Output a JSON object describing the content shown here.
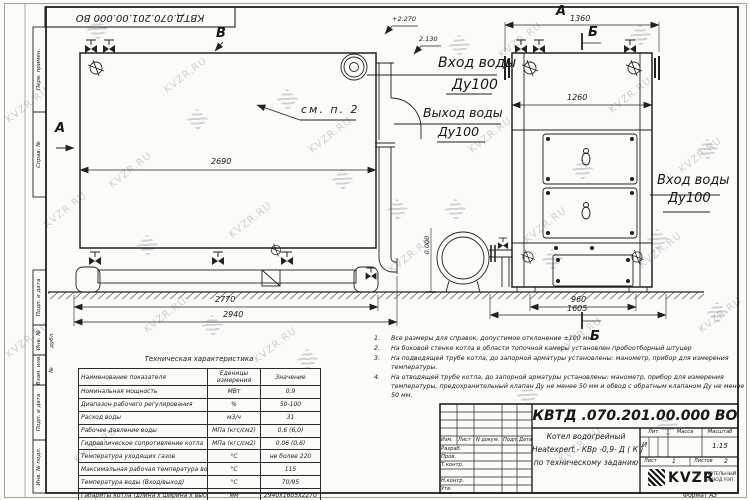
{
  "sheet": {
    "watermark": "KVZR.RU",
    "stamp": "КВТД.070.201.00.000  ВО",
    "format_note": "Формат    А3"
  },
  "margin_labels": [
    {
      "label": "Перв. примен."
    },
    {
      "label": "Справ. №"
    },
    {
      "label": "Подп. и дата"
    },
    {
      "label": "Инв. № дубл."
    },
    {
      "label": "Взам. инв. №"
    },
    {
      "label": "Подп. и дата"
    },
    {
      "label": "Инв. № подл."
    }
  ],
  "side_view": {
    "view_b": "В",
    "view_a": "А",
    "see_note": "см. п. 2",
    "elev_top": "+2.270",
    "elev_inlet": "2.130",
    "elev_ground": "0.000",
    "inlet_line1": "Вход воды",
    "inlet_line2": "Ду100",
    "outlet_line1": "Выход воды",
    "outlet_line2": "Ду100",
    "dim_body": "2690",
    "dim_base": "2770",
    "dim_overall": "2940"
  },
  "front_view": {
    "view_label": "А",
    "section_label_top": "Б",
    "section_label_bottom": "Б",
    "dim_top": "1360",
    "dim_inner": "1260",
    "dim_base": "960",
    "dim_overall": "1605",
    "inlet_line1": "Вход воды",
    "inlet_line2": "Ду100"
  },
  "tech_table": {
    "title": "Техническая характеристика",
    "col_name": "Наименование показателя",
    "col_units_1": "Еденицы",
    "col_units_2": "измерения",
    "col_value": "Значение",
    "rows": [
      {
        "name": "Номинальная мощность",
        "units": "МВт",
        "value": "0,9"
      },
      {
        "name": "Диапазон рабочего регулирования",
        "units": "%",
        "value": "50-100"
      },
      {
        "name": "Расход воды",
        "units": "м3/ч",
        "value": "31"
      },
      {
        "name": "Рабочее давление воды",
        "units": "МПа (кгс/см2)",
        "value": "0,6 (6,0)"
      },
      {
        "name": "Гидравлическое сопротивление котла",
        "units": "МПа (кгс/см2)",
        "value": "0,06 (0,6)"
      },
      {
        "name": "Температура уходящих газов",
        "units": "°С",
        "value": "не более 220"
      },
      {
        "name": "Максимальная рабочая температура воды",
        "units": "°С",
        "value": "115"
      },
      {
        "name": "Температура воды (Вход/выход)",
        "units": "°С",
        "value": "70/95"
      },
      {
        "name": "Габариты котла (длина х ширина х высота)",
        "units": "мм",
        "value": "2940х1605х2270"
      }
    ]
  },
  "notes": [
    {
      "num": "1.",
      "line1": "Все размеры для справок, допустимое отклонение  ±100 мм."
    },
    {
      "num": "2.",
      "line1": "На боковой стенке котла в области топочной камеры установлен пробоотборный штуцер"
    },
    {
      "num": "3.",
      "line1": "На  подводящей трубе котла, до запорной арматуры установлены: манометр, прибор для измерения",
      "line2": "температуры."
    },
    {
      "num": "4.",
      "line1": "На отводящей трубе котла, до запорной арматуры установлены: манометр, прибор для измерения",
      "line2": "температуры, предохранительный клапан  Ду не менее 50 мм и обвод с обратным клапаном  Ду не менее",
      "line3": "50 мм."
    }
  ],
  "title_block": {
    "doc_number": "КВТД .070.201.00.000   ВО",
    "name_line1": "Котел водогрейный",
    "name_line2": "Heatexpert - КВр -0,9- Д ( К )",
    "name_line3": "по техническому заданию",
    "col_izm": "Изм.",
    "col_list": "Лист",
    "col_doc": "N докум.",
    "col_sign": "Подп.",
    "col_date": "Дата",
    "row_developed": "Разраб.",
    "row_checked": "Пров.",
    "row_tcontrol": "Т.контр.",
    "row_ncontrol": "Н.контр.",
    "row_approved": "Утв.",
    "lit_label": "Лит.",
    "lit_value": "И",
    "mass_label": "Масса",
    "scale_label": "Масштаб",
    "scale_value": "1:15",
    "sheet_label": "Лист",
    "sheet_value": "1",
    "sheets_label": "Листов",
    "sheets_value": "2",
    "logo_text": "KVZR",
    "company_line1": "КОТЕЛЬНЫЙ",
    "company_line2": "ЗАВОД РЭП"
  }
}
